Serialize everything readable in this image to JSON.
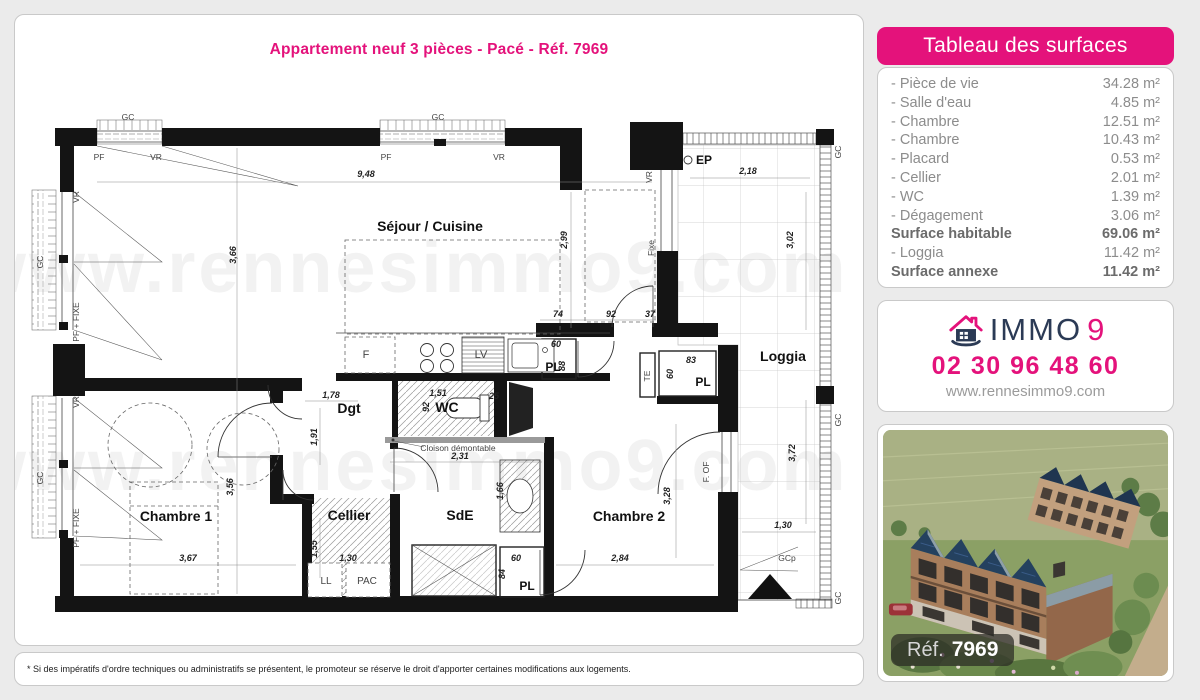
{
  "title": "Appartement neuf 3 pièces - Pacé - Réf. 7969",
  "watermark": "www.rennesimmo9.com",
  "disclaimer": "* Si des impératifs d'ordre techniques ou administratifs se présentent, le promoteur se réserve le droit d'apporter certaines modifications aux logements.",
  "colors": {
    "accent_pink": "#e4127b",
    "brand_navy": "#2b3a55",
    "table_gray": "#8c8c8c"
  },
  "surfaces_panel": {
    "header": "Tableau des surfaces",
    "rows": [
      {
        "label": "- Pièce de vie",
        "value": "34.28 m²",
        "bold": false
      },
      {
        "label": "- Salle d'eau",
        "value": "4.85 m²",
        "bold": false
      },
      {
        "label": "- Chambre",
        "value": "12.51 m²",
        "bold": false
      },
      {
        "label": "- Chambre",
        "value": "10.43 m²",
        "bold": false
      },
      {
        "label": "- Placard",
        "value": "0.53 m²",
        "bold": false
      },
      {
        "label": "- Cellier",
        "value": "2.01 m²",
        "bold": false
      },
      {
        "label": "- WC",
        "value": "1.39 m²",
        "bold": false
      },
      {
        "label": "- Dégagement",
        "value": "3.06 m²",
        "bold": false
      },
      {
        "label": "Surface habitable",
        "value": "69.06 m²",
        "bold": true
      },
      {
        "label": "- Loggia",
        "value": "11.42 m²",
        "bold": false
      },
      {
        "label": "Surface annexe",
        "value": "11.42 m²",
        "bold": true
      }
    ]
  },
  "agency": {
    "brand_immo": "IMMO",
    "brand_9": "9",
    "phone": "02 30 96 48 60",
    "website": "www.rennesimmo9.com"
  },
  "photo": {
    "ref_label": "Réf.",
    "ref_number": "7969"
  },
  "floorplan": {
    "room_labels": [
      {
        "t": "Séjour / Cuisine",
        "x": 430,
        "y": 231,
        "s": 14
      },
      {
        "t": "Chambre 1",
        "x": 176,
        "y": 521,
        "s": 14
      },
      {
        "t": "Chambre 2",
        "x": 629,
        "y": 521,
        "s": 14
      },
      {
        "t": "Cellier",
        "x": 349,
        "y": 520,
        "s": 14
      },
      {
        "t": "SdE",
        "x": 460,
        "y": 520,
        "s": 14
      },
      {
        "t": "WC",
        "x": 447,
        "y": 412,
        "s": 14
      },
      {
        "t": "Dgt",
        "x": 349,
        "y": 413,
        "s": 14
      },
      {
        "t": "PL",
        "x": 553,
        "y": 371,
        "s": 12
      },
      {
        "t": "PL",
        "x": 703,
        "y": 386,
        "s": 12
      },
      {
        "t": "PL",
        "x": 527,
        "y": 590,
        "s": 12
      },
      {
        "t": "Loggia",
        "x": 783,
        "y": 361,
        "s": 14
      },
      {
        "t": "EP",
        "x": 704,
        "y": 164,
        "s": 12
      }
    ],
    "dimensions": [
      {
        "t": "9,48",
        "x": 366,
        "y": 177
      },
      {
        "t": "3,66",
        "x": 236,
        "y": 255,
        "r": -90
      },
      {
        "t": "3,56",
        "x": 233,
        "y": 487,
        "r": -90
      },
      {
        "t": "2,99",
        "x": 567,
        "y": 240,
        "r": -90
      },
      {
        "t": "2,18",
        "x": 748,
        "y": 174
      },
      {
        "t": "3,02",
        "x": 793,
        "y": 240,
        "r": -90
      },
      {
        "t": "3,72",
        "x": 795,
        "y": 453,
        "r": -90
      },
      {
        "t": "1,30",
        "x": 783,
        "y": 528
      },
      {
        "t": "1,78",
        "x": 331,
        "y": 398
      },
      {
        "t": "1,91",
        "x": 317,
        "y": 437,
        "r": -90
      },
      {
        "t": "1,51",
        "x": 438,
        "y": 396
      },
      {
        "t": "92",
        "x": 429,
        "y": 407,
        "r": -90
      },
      {
        "t": "25",
        "x": 494,
        "y": 399
      },
      {
        "t": "74",
        "x": 558,
        "y": 317
      },
      {
        "t": "92",
        "x": 611,
        "y": 317
      },
      {
        "t": "37",
        "x": 650,
        "y": 317
      },
      {
        "t": "60",
        "x": 556,
        "y": 347
      },
      {
        "t": "88",
        "x": 565,
        "y": 366,
        "r": -90
      },
      {
        "t": "83",
        "x": 691,
        "y": 363
      },
      {
        "t": "60",
        "x": 673,
        "y": 374,
        "r": -90
      },
      {
        "t": "2,31",
        "x": 460,
        "y": 459
      },
      {
        "t": "1,66",
        "x": 503,
        "y": 491,
        "r": -90
      },
      {
        "t": "1,55",
        "x": 317,
        "y": 549,
        "r": -90
      },
      {
        "t": "1,30",
        "x": 348,
        "y": 561
      },
      {
        "t": "3,67",
        "x": 188,
        "y": 561
      },
      {
        "t": "2,84",
        "x": 620,
        "y": 561
      },
      {
        "t": "3,28",
        "x": 670,
        "y": 496,
        "r": -90
      },
      {
        "t": "60",
        "x": 516,
        "y": 561
      },
      {
        "t": "84",
        "x": 505,
        "y": 574,
        "r": -90
      }
    ],
    "annotations": [
      {
        "t": "GC",
        "x": 128,
        "y": 120
      },
      {
        "t": "GC",
        "x": 438,
        "y": 120
      },
      {
        "t": "GC",
        "x": 43,
        "y": 262,
        "r": -90
      },
      {
        "t": "GC",
        "x": 43,
        "y": 478,
        "r": -90
      },
      {
        "t": "GC",
        "x": 841,
        "y": 152,
        "r": -90
      },
      {
        "t": "GC",
        "x": 841,
        "y": 420,
        "r": -90
      },
      {
        "t": "GC",
        "x": 841,
        "y": 598,
        "r": -90
      },
      {
        "t": "PF",
        "x": 99,
        "y": 160
      },
      {
        "t": "VR",
        "x": 156,
        "y": 160
      },
      {
        "t": "PF",
        "x": 386,
        "y": 160
      },
      {
        "t": "VR",
        "x": 499,
        "y": 160
      },
      {
        "t": "VR",
        "x": 79,
        "y": 197,
        "r": -90
      },
      {
        "t": "PF + FIXE",
        "x": 79,
        "y": 322,
        "r": -90
      },
      {
        "t": "VR",
        "x": 79,
        "y": 402,
        "r": -90
      },
      {
        "t": "PF + FIXE",
        "x": 79,
        "y": 528,
        "r": -90
      },
      {
        "t": "VR",
        "x": 652,
        "y": 177,
        "r": -90
      },
      {
        "t": "Fixe",
        "x": 654,
        "y": 248,
        "r": -90
      },
      {
        "t": "F. OF",
        "x": 709,
        "y": 472,
        "r": -90
      },
      {
        "t": "TE",
        "x": 650,
        "y": 376,
        "r": -90
      },
      {
        "t": "LL",
        "x": 326,
        "y": 584,
        "s": 10
      },
      {
        "t": "PAC",
        "x": 367,
        "y": 584,
        "s": 10
      },
      {
        "t": "F",
        "x": 366,
        "y": 358,
        "s": 11
      },
      {
        "t": "LV",
        "x": 481,
        "y": 358,
        "s": 11
      },
      {
        "t": "GCp",
        "x": 787,
        "y": 561
      },
      {
        "t": "Cloison démontable",
        "x": 458,
        "y": 451
      }
    ]
  }
}
